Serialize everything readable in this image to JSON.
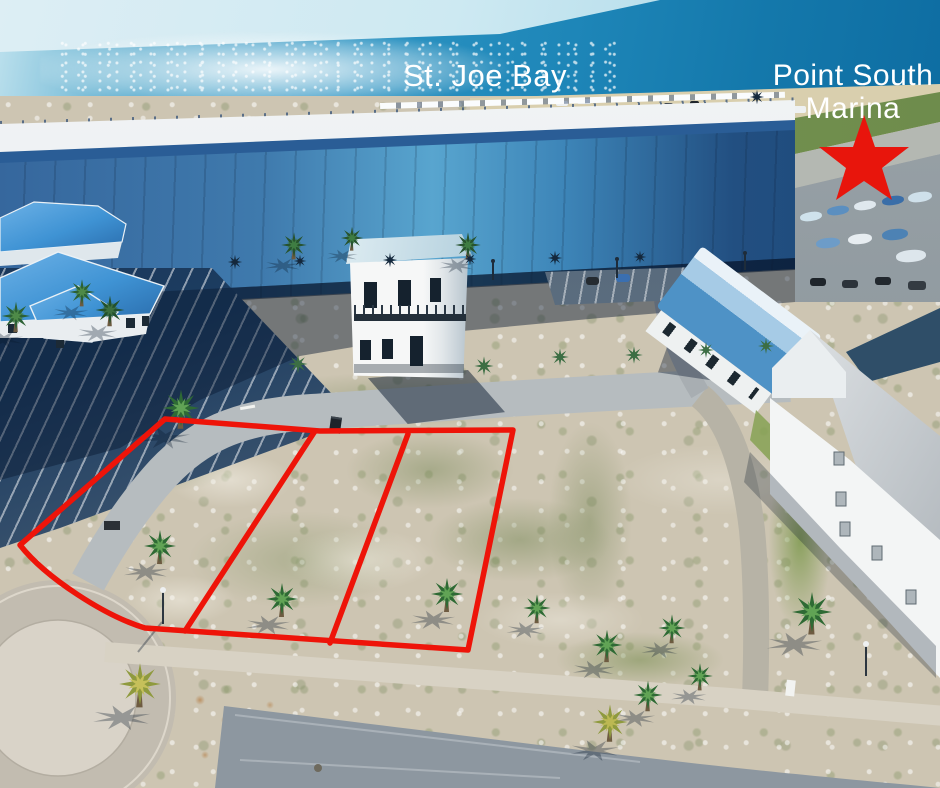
{
  "photo": {
    "type": "aerial-drone-photo",
    "subject": "Vacant waterfront-area lots outlined for sale near marina",
    "width": 940,
    "height": 788
  },
  "labels": {
    "bay": "St. Joe Bay",
    "marina_line1": "Point South",
    "marina_line2": "Marina"
  },
  "annotations": {
    "lot_outline": {
      "color": "#ee1409",
      "stroke_width": 5.5,
      "lot_count": 3,
      "outer_path": "M165,419 L320,431 L513,430 L468,650 L145,628 C105,616 46,578 20,545 Z",
      "dividers": [
        "M315,431 L185,631",
        "M408,434 L330,643"
      ]
    },
    "marker": {
      "type": "star",
      "color": "#e8150c",
      "points": "864,115 875,147 909,147 882,168 892,200 864,181 836,200 846,168 819,147 853,147"
    }
  },
  "palette": {
    "water_blue": "#1f87ba",
    "annotation_red": "#ee1409",
    "metal_roof_blue": "#3f93d4",
    "warehouse_wall_blue": "#3a6ea6",
    "sand": "#cfc7b4",
    "asphalt": "#8d97a0",
    "label_text": "#ffffff"
  }
}
